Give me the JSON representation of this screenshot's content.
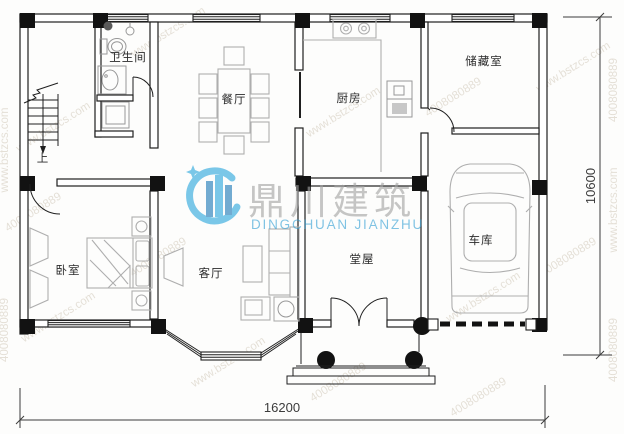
{
  "title": "residential-floor-plan",
  "rooms": [
    {
      "id": "bathroom",
      "label": "卫生间"
    },
    {
      "id": "dining",
      "label": "餐厅"
    },
    {
      "id": "kitchen",
      "label": "厨房"
    },
    {
      "id": "storage",
      "label": "储藏室"
    },
    {
      "id": "bedroom",
      "label": "卧室"
    },
    {
      "id": "living",
      "label": "客厅"
    },
    {
      "id": "hall",
      "label": "堂屋"
    },
    {
      "id": "garage",
      "label": "车库"
    }
  ],
  "stairs": {
    "up_label": "上"
  },
  "dimensions": {
    "width_mm": "16200",
    "height_mm": "10600"
  },
  "watermark": {
    "logo_cn": "鼎川建筑",
    "logo_en": "DINGCHUAN JIANZHU",
    "site": "www.bstzcs.com",
    "phone": "4008080889",
    "accent_blue": "#2ba7dd",
    "accent_dark_blue": "#1e7ab8",
    "logo_gray": "#a3a3a3",
    "tile_text_color": "#b3a58c"
  },
  "colors": {
    "wall": "#1f1f1f",
    "furniture": "#aeaeae",
    "dimension": "#3c3c3c"
  }
}
